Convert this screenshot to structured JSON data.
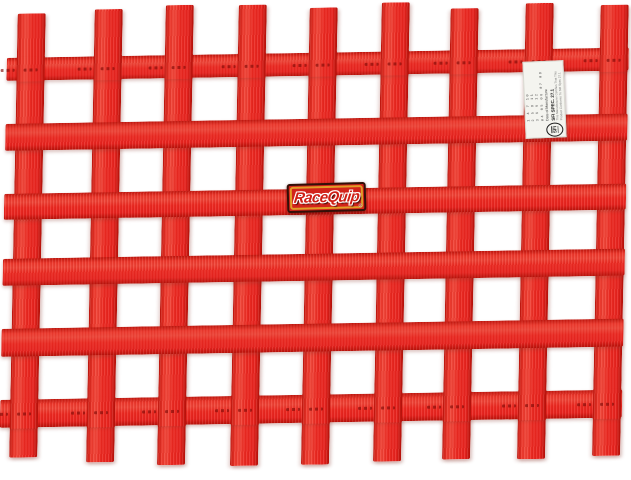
{
  "image": {
    "width": 631,
    "height": 480,
    "subject": "Red RaceQuip ribbon-style racing window net photographed on a white background"
  },
  "colors": {
    "webbing_red": "#ed2a22",
    "webbing_dark_edge": "#b8120a",
    "label_background": "#d2231a",
    "label_gold_frame": "#e19d27",
    "label_border": "#340f08",
    "tag_white": "#f4f4ef",
    "background": "#ffffff"
  },
  "brand_label": {
    "text": "RaceQuip",
    "registered_mark": "®"
  },
  "sfi_tag": {
    "logo_text": "SFI",
    "spec_line": "SFI SPEC. 27.1",
    "date_label": "Date of Manufacture",
    "month_rows": [
      "1 4 7 10",
      "2 5 8 11",
      "3 6 9 12"
    ],
    "year_row": "04 05 06 07 08",
    "fine_print": [
      "This Manufacturer Certifies That This",
      "Product Conforms To SFI Spec 27.1"
    ]
  },
  "net": {
    "skew_x_deg": -1.1,
    "skew_y_deg": -0.95,
    "strap_width": 28,
    "h_left": 8,
    "h_right": 630,
    "weave_over_rows": [
      0,
      5
    ],
    "vertical_straps": [
      {
        "left": 18,
        "top": 14,
        "bottom": 458
      },
      {
        "left": 95,
        "top": 11,
        "bottom": 464
      },
      {
        "left": 166,
        "top": 8,
        "bottom": 468
      },
      {
        "left": 239,
        "top": 9,
        "bottom": 470
      },
      {
        "left": 310,
        "top": 13,
        "bottom": 470
      },
      {
        "left": 382,
        "top": 9,
        "bottom": 468
      },
      {
        "left": 451,
        "top": 16,
        "bottom": 467
      },
      {
        "left": 526,
        "top": 12,
        "bottom": 468
      },
      {
        "left": 601,
        "top": 15,
        "bottom": 466
      }
    ],
    "horizontal_straps": [
      {
        "top": 58,
        "height": 23
      },
      {
        "top": 124,
        "height": 27
      },
      {
        "top": 194,
        "height": 26
      },
      {
        "top": 259,
        "height": 27
      },
      {
        "top": 329,
        "height": 28
      },
      {
        "top": 400,
        "height": 28
      }
    ]
  }
}
